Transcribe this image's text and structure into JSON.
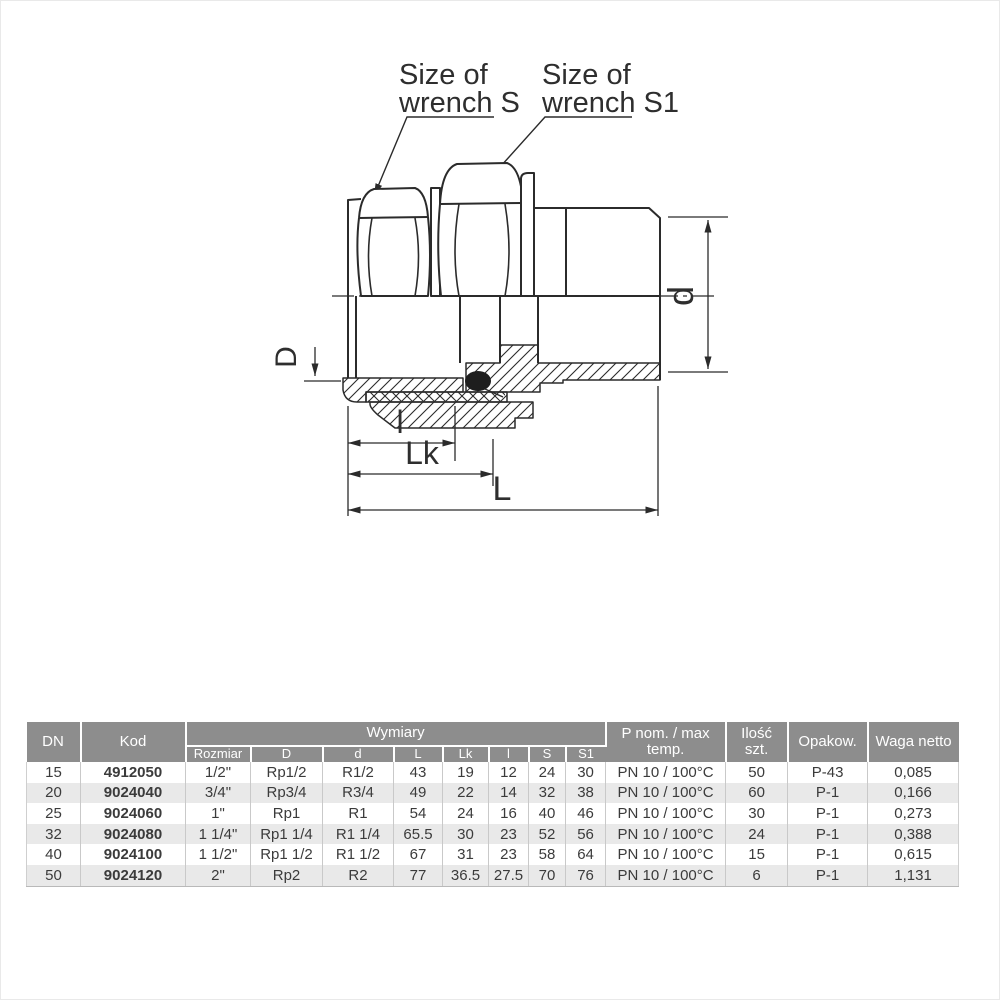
{
  "drawing": {
    "callout_s": {
      "line1": "Size of",
      "line2": "wrench S"
    },
    "callout_s1": {
      "line1": "Size of",
      "line2": "wrench S1"
    },
    "dims": {
      "D": "D",
      "d": "d",
      "l": "l",
      "Lk": "Lk",
      "L": "L"
    },
    "line_color": "#2b2b2b"
  },
  "table": {
    "header": {
      "dn": "DN",
      "kod": "Kod",
      "wymiary": "Wymiary",
      "sub": [
        "Rozmiar",
        "D",
        "d",
        "L",
        "Lk",
        "l",
        "S",
        "S1"
      ],
      "pnom_line1": "P nom. / max",
      "pnom_line2": "temp.",
      "ilosc_line1": "Ilość",
      "ilosc_line2": "szt.",
      "opakow": "Opakow.",
      "waga": "Waga netto"
    },
    "rows": [
      [
        "15",
        "4912050",
        "1/2\"",
        "Rp1/2",
        "R1/2",
        "43",
        "19",
        "12",
        "24",
        "30",
        "PN 10 / 100°C",
        "50",
        "P-43",
        "0,085"
      ],
      [
        "20",
        "9024040",
        "3/4\"",
        "Rp3/4",
        "R3/4",
        "49",
        "22",
        "14",
        "32",
        "38",
        "PN 10 / 100°C",
        "60",
        "P-1",
        "0,166"
      ],
      [
        "25",
        "9024060",
        "1\"",
        "Rp1",
        "R1",
        "54",
        "24",
        "16",
        "40",
        "46",
        "PN 10 / 100°C",
        "30",
        "P-1",
        "0,273"
      ],
      [
        "32",
        "9024080",
        "1 1/4\"",
        "Rp1 1/4",
        "R1 1/4",
        "65.5",
        "30",
        "23",
        "52",
        "56",
        "PN 10 / 100°C",
        "24",
        "P-1",
        "0,388"
      ],
      [
        "40",
        "9024100",
        "1 1/2\"",
        "Rp1 1/2",
        "R1 1/2",
        "67",
        "31",
        "23",
        "58",
        "64",
        "PN 10 / 100°C",
        "15",
        "P-1",
        "0,615"
      ],
      [
        "50",
        "9024120",
        "2\"",
        "Rp2",
        "R2",
        "77",
        "36.5",
        "27.5",
        "70",
        "76",
        "PN 10 / 100°C",
        "6",
        "P-1",
        "1,131"
      ]
    ],
    "colors": {
      "header_bg": "#8d8d8d",
      "subheader_bg": "#b4b4b4",
      "row_alt_bg": "#e9e9e9"
    }
  }
}
